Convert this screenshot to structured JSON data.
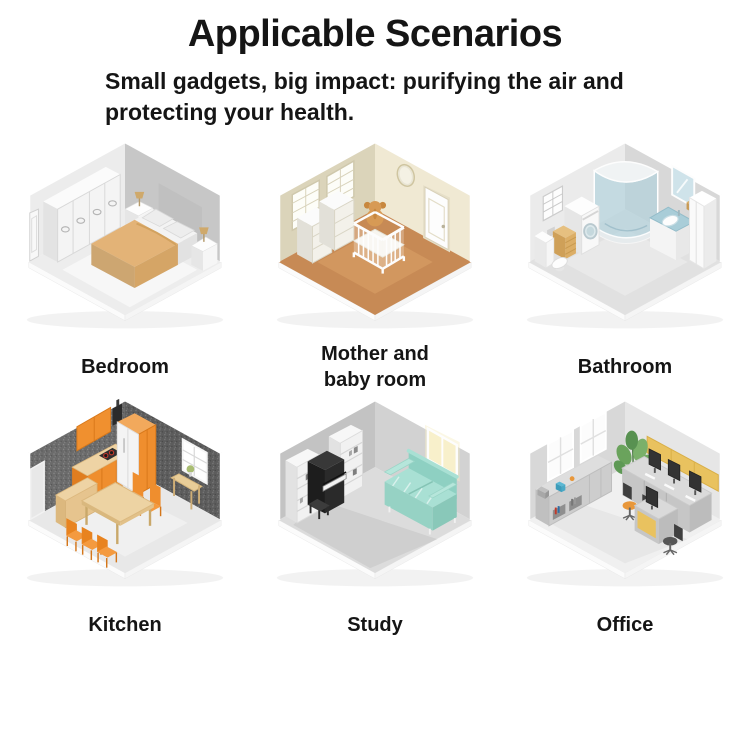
{
  "page": {
    "title": "Applicable Scenarios",
    "subtitle": "Small gadgets, big impact: purifying the air and protecting your health."
  },
  "scenarios": [
    {
      "label": "Bedroom",
      "illustration": "bedroom-isometric-room"
    },
    {
      "label": "Mother and baby room",
      "illustration": "mother-baby-room-isometric-room"
    },
    {
      "label": "Bathroom",
      "illustration": "bathroom-isometric-room"
    },
    {
      "label": "Kitchen",
      "illustration": "kitchen-isometric-room"
    },
    {
      "label": "Study",
      "illustration": "study-isometric-room"
    },
    {
      "label": "Office",
      "illustration": "office-isometric-room"
    }
  ],
  "colors": {
    "text": "#151515",
    "background": "#ffffff",
    "bed_blanket_tan": "#e3b377",
    "nursery_floor_terracotta": "#c78a55",
    "bathroom_glass_blue": "#add0dc",
    "kitchen_cabinet_orange": "#ef8e2e",
    "study_sofa_mint": "#a9e0d4",
    "office_partition_yellow": "#e9c25f"
  }
}
